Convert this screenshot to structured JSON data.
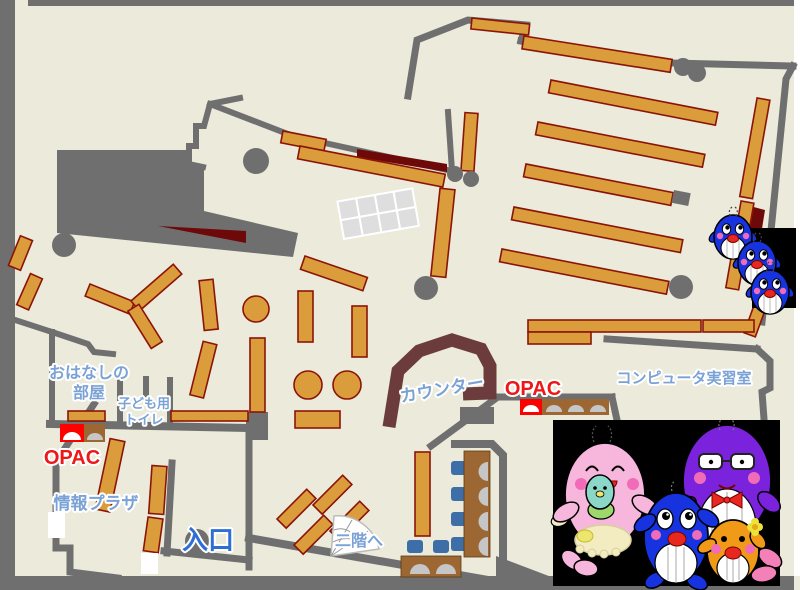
{
  "map": {
    "labels": {
      "storytime_line1": "おはなしの",
      "storytime_line2": "部屋",
      "toilet_line1": "子ども用",
      "toilet_line2": "トイレ",
      "opac_left": "OPAC",
      "opac_center": "OPAC",
      "counter": "カウンター",
      "computer_room": "コンピュータ実習室",
      "info_plaza": "情報プラザ",
      "entrance": "入口",
      "to_second_floor": "二階へ"
    },
    "colors": {
      "floor": "#EBEADB",
      "wall": "#6F6F6F",
      "shelf": "#DB9D3B",
      "shelf_border": "#8B1408",
      "shadow_dark_red": "#6E0909",
      "counter_brown": "#6C3C3C",
      "label_blue": "#7BA2D5",
      "entrance_blue": "#2E6FD6",
      "opac_red": "#EE1616",
      "opac_terminal_red": "#FF0000",
      "chair_blue": "#3D6EA8",
      "desk_brown": "#9C6733",
      "mascot_pink": "#F7B6DC",
      "mascot_blue": "#1733E0",
      "mascot_purple": "#7B22DC",
      "mascot_orange": "#F09A18"
    },
    "mascots": {
      "family": [
        "pink-whale-parent-icon",
        "teal-whale-baby-icon",
        "blue-whale-child-icon",
        "purple-whale-parent-icon",
        "orange-whale-child-icon"
      ],
      "right_edge": [
        "blue-whale-icon",
        "blue-whale-icon",
        "blue-whale-icon"
      ]
    }
  }
}
